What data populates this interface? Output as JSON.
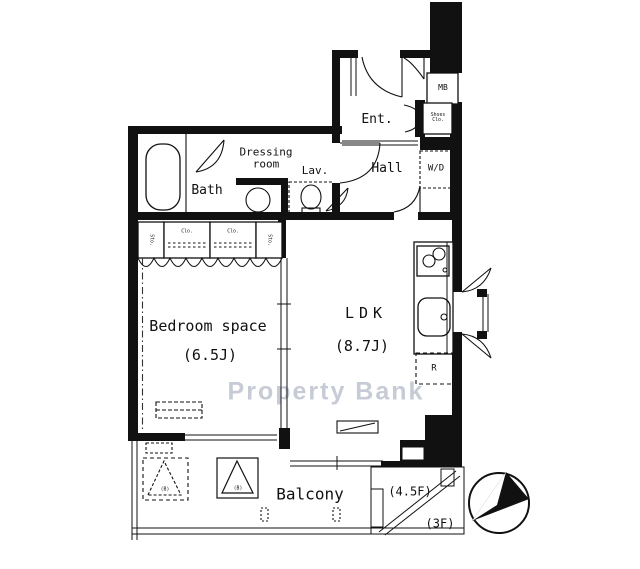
{
  "plan": {
    "watermark": "Property Bank",
    "rooms": {
      "bedroom_label": "Bedroom space",
      "bedroom_size": "(6.5J)",
      "ldk_label": "LDK",
      "ldk_size": "(8.7J)",
      "balcony_label": "Balcony",
      "entrance_label": "Ent.",
      "hall_label": "Hall",
      "bath_label": "Bath",
      "dressing_line1": "Dressing",
      "dressing_line2": "room",
      "lavatory_label": "Lav."
    },
    "fixtures": {
      "meter_box": "MB",
      "shoes_closet_line1": "Shoes",
      "shoes_closet_line2": "Clo.",
      "washer_dryer": "W/D",
      "refrigerator": "R",
      "hatch_left": "(B)",
      "hatch_right": "(B)"
    },
    "storage": {
      "sto_left": "Sto.",
      "clo_left": "Clo.",
      "clo_right": "Clo.",
      "sto_right": "Sto."
    },
    "stairwell": {
      "upper_floors": "(4.5F)",
      "lower_floor": "(3F)"
    },
    "colors": {
      "line": "#111111",
      "watermark": "#c6cbd5"
    }
  }
}
